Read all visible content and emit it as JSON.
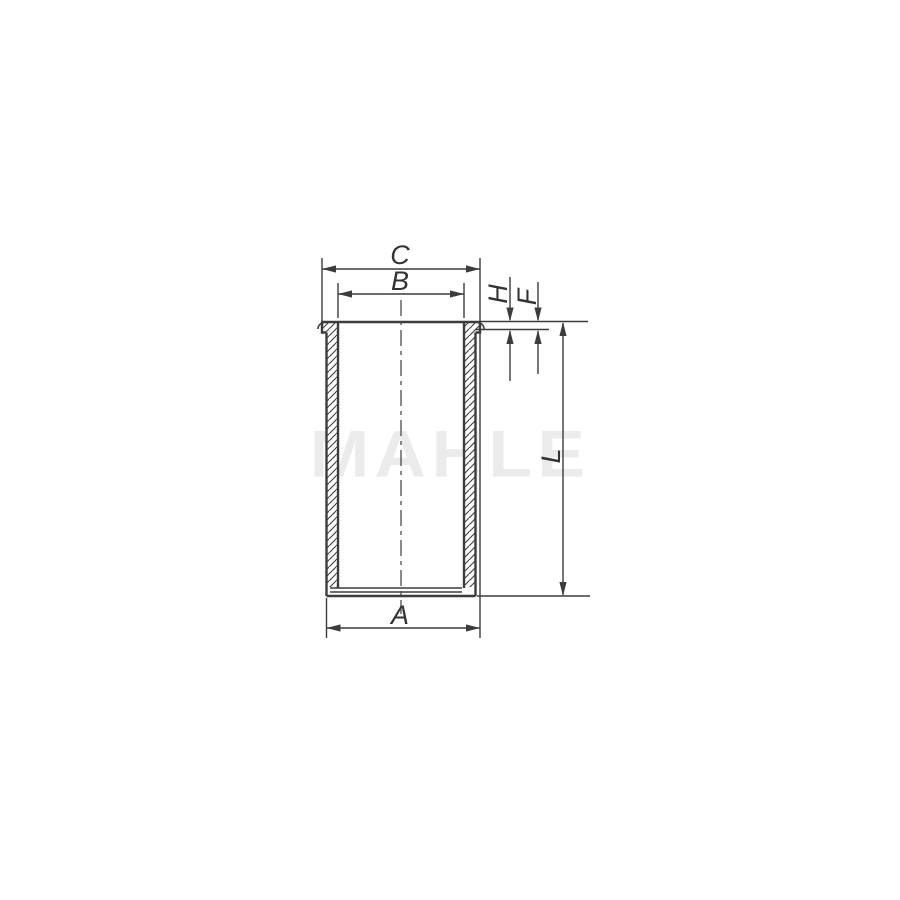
{
  "figure": {
    "title": "cylinder liner sectional technical drawing",
    "watermark": "MAHLE",
    "labels": {
      "c": "C",
      "b": "B",
      "a": "A",
      "h": "H",
      "f": "F",
      "l": "L"
    },
    "dimensions": [
      {
        "id": "C",
        "description": "top horizontal dimension, outer collar width"
      },
      {
        "id": "B",
        "description": "top horizontal dimension, inner bore width"
      },
      {
        "id": "H",
        "description": "small vertical dimension at collar, outer reference pair"
      },
      {
        "id": "F",
        "description": "small vertical dimension at collar, offset reference pair"
      },
      {
        "id": "L",
        "description": "right vertical dimension, total liner length"
      },
      {
        "id": "A",
        "description": "bottom horizontal dimension, outer body width"
      }
    ]
  },
  "colors": {
    "background": "#ffffff",
    "line": "#3c3c3c",
    "label": "#333333",
    "watermark": "#ebebeb"
  }
}
